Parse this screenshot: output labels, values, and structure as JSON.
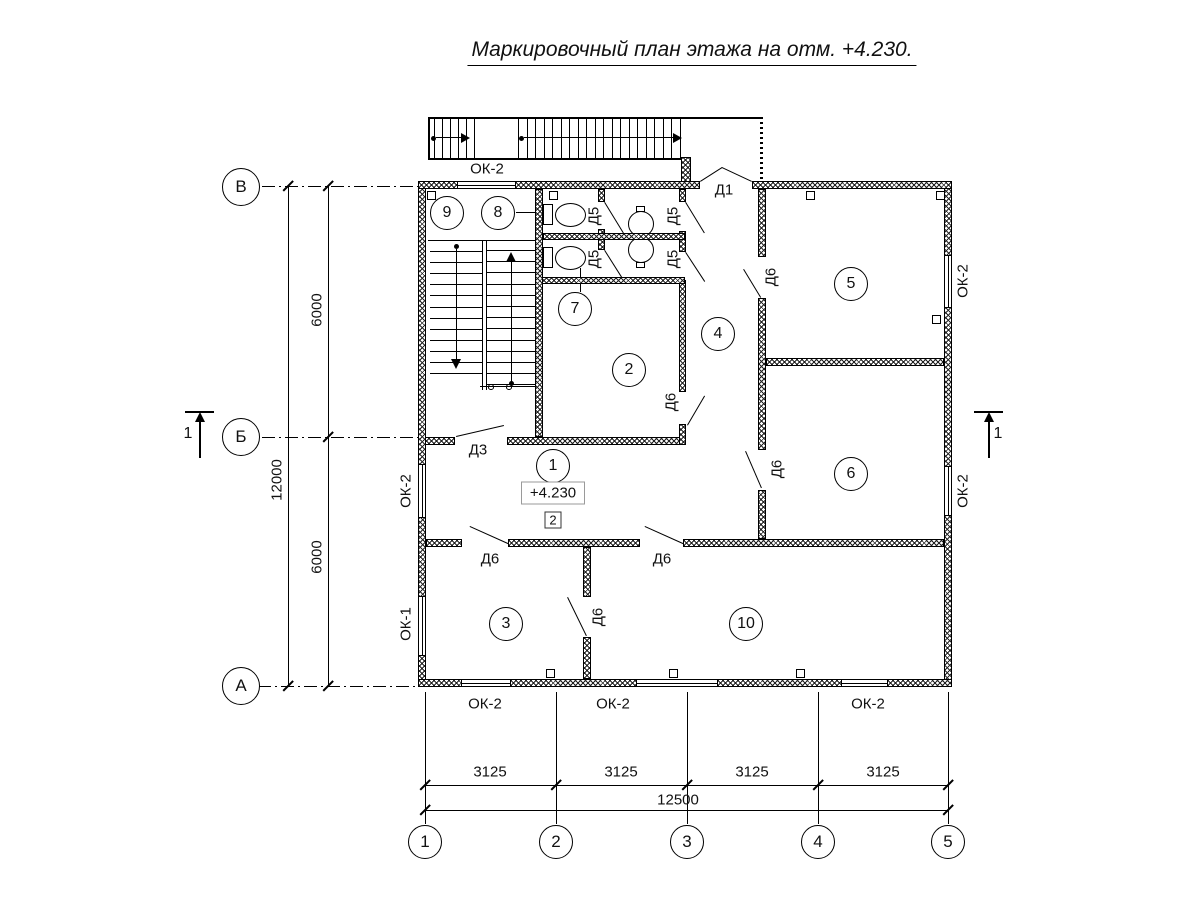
{
  "title": "Маркировочный план этажа на отм. +4.230.",
  "rooms": [
    "1",
    "2",
    "3",
    "4",
    "5",
    "6",
    "7",
    "8",
    "9",
    "10"
  ],
  "doors": {
    "d1": "Д1",
    "d3": "Д3",
    "d5": "Д5",
    "d6": "Д6"
  },
  "windows": {
    "ok1": "ОК-1",
    "ok2": "ОК-2"
  },
  "axes": {
    "rows": [
      "В",
      "Б",
      "А"
    ],
    "cols": [
      "1",
      "2",
      "3",
      "4",
      "5"
    ]
  },
  "dims": {
    "left_segments": [
      "6000",
      "6000"
    ],
    "left_total": "12000",
    "bottom_segments": [
      "3125",
      "3125",
      "3125",
      "3125"
    ],
    "bottom_total": "12500"
  },
  "marks": {
    "elevation": "+4.230",
    "floor_type": "2",
    "section": "1"
  }
}
